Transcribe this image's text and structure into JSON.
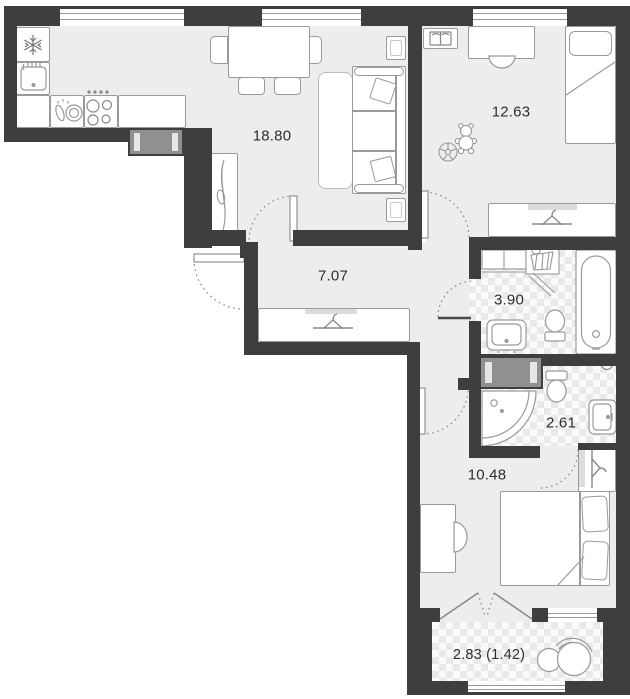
{
  "rooms": {
    "living_kitchen": {
      "area": "18.80"
    },
    "child_bedroom": {
      "area": "12.63"
    },
    "hallway": {
      "area": "7.07"
    },
    "bathroom": {
      "area": "3.90"
    },
    "shower_room": {
      "area": "2.61"
    },
    "bedroom": {
      "area": "10.48"
    },
    "balcony": {
      "area": "2.83 (1.42)"
    }
  },
  "colors": {
    "wall": "#3e3e3e",
    "floor": "#ededed",
    "tile_bg": "#fafafa",
    "tile_diamond": "#e9e9e9",
    "outline": "#9a9a9a",
    "text": "#2f2f2f",
    "radiator": "#909090"
  },
  "icons": {
    "fridge": "snowflake-icon",
    "kitchen_sink": "sink-icon",
    "stove": "burners-icon",
    "dishes": "dishes-icon",
    "cabinet_decor": "plant-leaf-icon",
    "bookshelf": "open-book-icon",
    "toys": [
      "teddy-bear-icon",
      "ball-icon"
    ],
    "wardrobes": "hanger-icon",
    "laundry": "basket-icon",
    "bath": "bathtub-icon",
    "toilets": "toilet-icon",
    "washbasins": "washbasin-icon",
    "shower": "shower-tray-icon"
  }
}
